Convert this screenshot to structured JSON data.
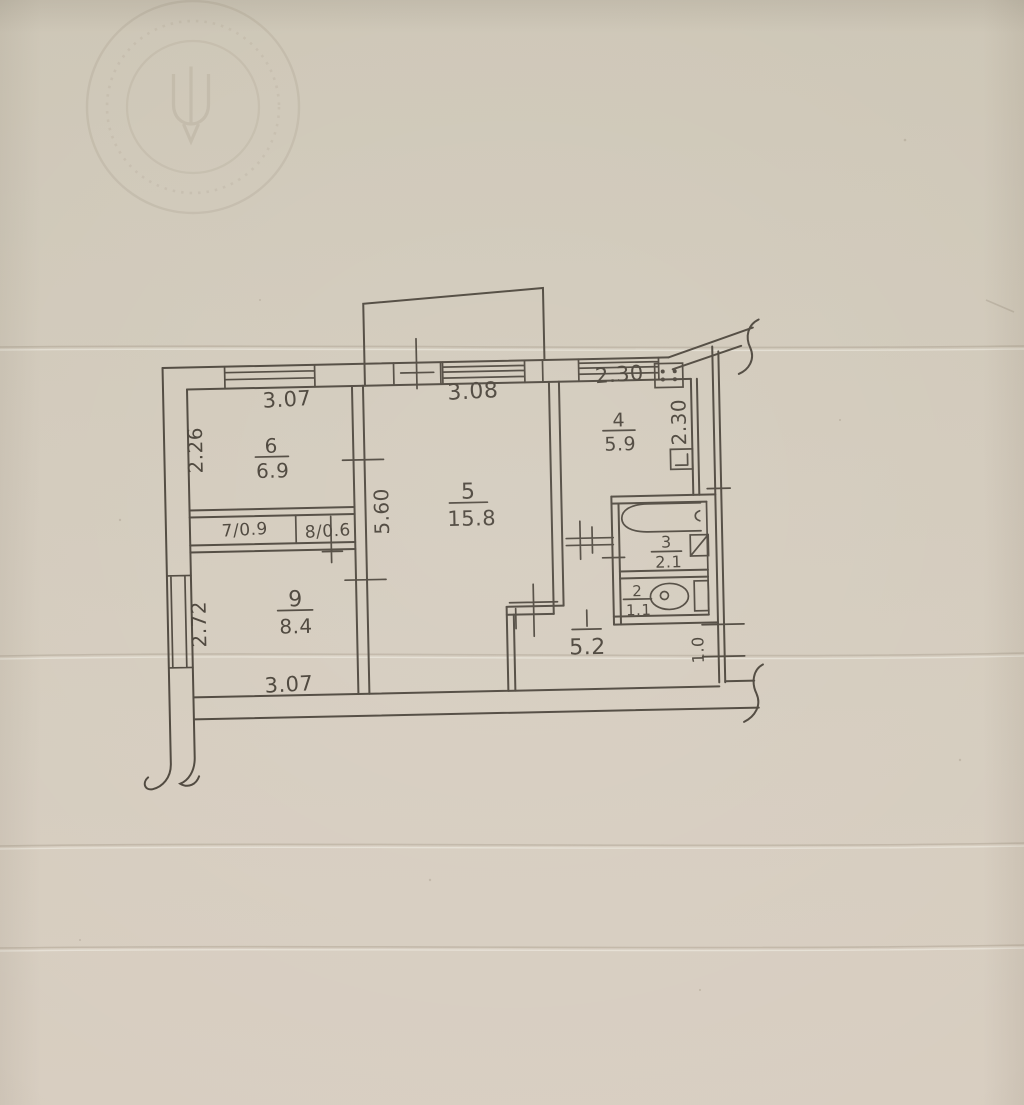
{
  "document": {
    "kind": "hand-drawn apartment floor plan on aged paper",
    "colors": {
      "paper": "#d2c9ba",
      "ink": "#4a4339",
      "stamp": "#8b7d68"
    }
  },
  "stamp": {
    "shape": "round seal, double circle",
    "emblem": "trident emblem, illegible ring text"
  },
  "rooms": {
    "living": {
      "number": "5",
      "area": "15.8"
    },
    "bedroom": {
      "number": "6",
      "area": "6.9"
    },
    "bedroom2": {
      "number": "9",
      "area": "8.4"
    },
    "kitchen": {
      "number": "4",
      "area": "5.9"
    },
    "bathroom": {
      "number": "3",
      "area": "2.1"
    },
    "toilet": {
      "number": "2",
      "area": "1.1"
    },
    "hall": {
      "number": "1",
      "area": "5.2"
    },
    "closet_left": {
      "label": "7/0.9"
    },
    "closet_right": {
      "label": "8/0.6"
    }
  },
  "dims": {
    "top_left": "3.07",
    "top_center": "3.08",
    "top_right": "2.30",
    "left_upper": "2.26",
    "left_lower": "2.72",
    "center_vertical": "5.60",
    "kitchen_vertical": "2.30",
    "bottom": "3.07",
    "entry_width": "1.0"
  },
  "fixtures": [
    "bathtub",
    "toilet",
    "wash-basin",
    "kitchen-sink",
    "gas-stove"
  ]
}
